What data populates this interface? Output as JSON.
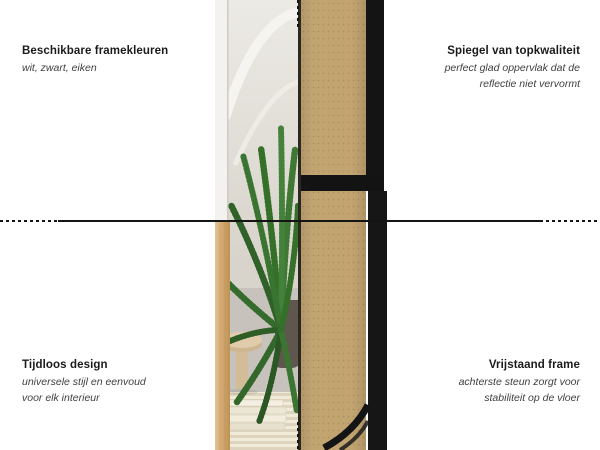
{
  "annotations": {
    "top_left": {
      "title": "Beschikbare framekleuren",
      "subtitle_line1": "wit, zwart, eiken"
    },
    "top_right": {
      "title": "Spiegel van topkwaliteit",
      "subtitle_line1": "perfect glad oppervlak dat de",
      "subtitle_line2": "reflectie niet vervormt"
    },
    "bottom_left": {
      "title": "Tijdloos design",
      "subtitle_line1": "universele stijl en eenvoud",
      "subtitle_line2": "voor elk interieur"
    },
    "bottom_right": {
      "title": "Vrijstaand frame",
      "subtitle_line1": "achterste steun zorgt voor",
      "subtitle_line2": "stabiliteit op de vloer"
    }
  },
  "figure": {
    "left_photo": "mirror-front-view-with-arch-and-palm-reflection",
    "right_photo": "mirror-back-view-mdf-panel-with-freestanding-support"
  },
  "colors": {
    "background": "#ffffff",
    "text_title": "#1b1b1b",
    "text_subtitle": "#3f3f3f",
    "divider_line": "#141414",
    "mdf_board": "#c2a471",
    "frame_black": "#141414",
    "frame_oak": "#cfa468",
    "frame_white": "#f3f2ef",
    "plant_green": "#3e7833"
  }
}
